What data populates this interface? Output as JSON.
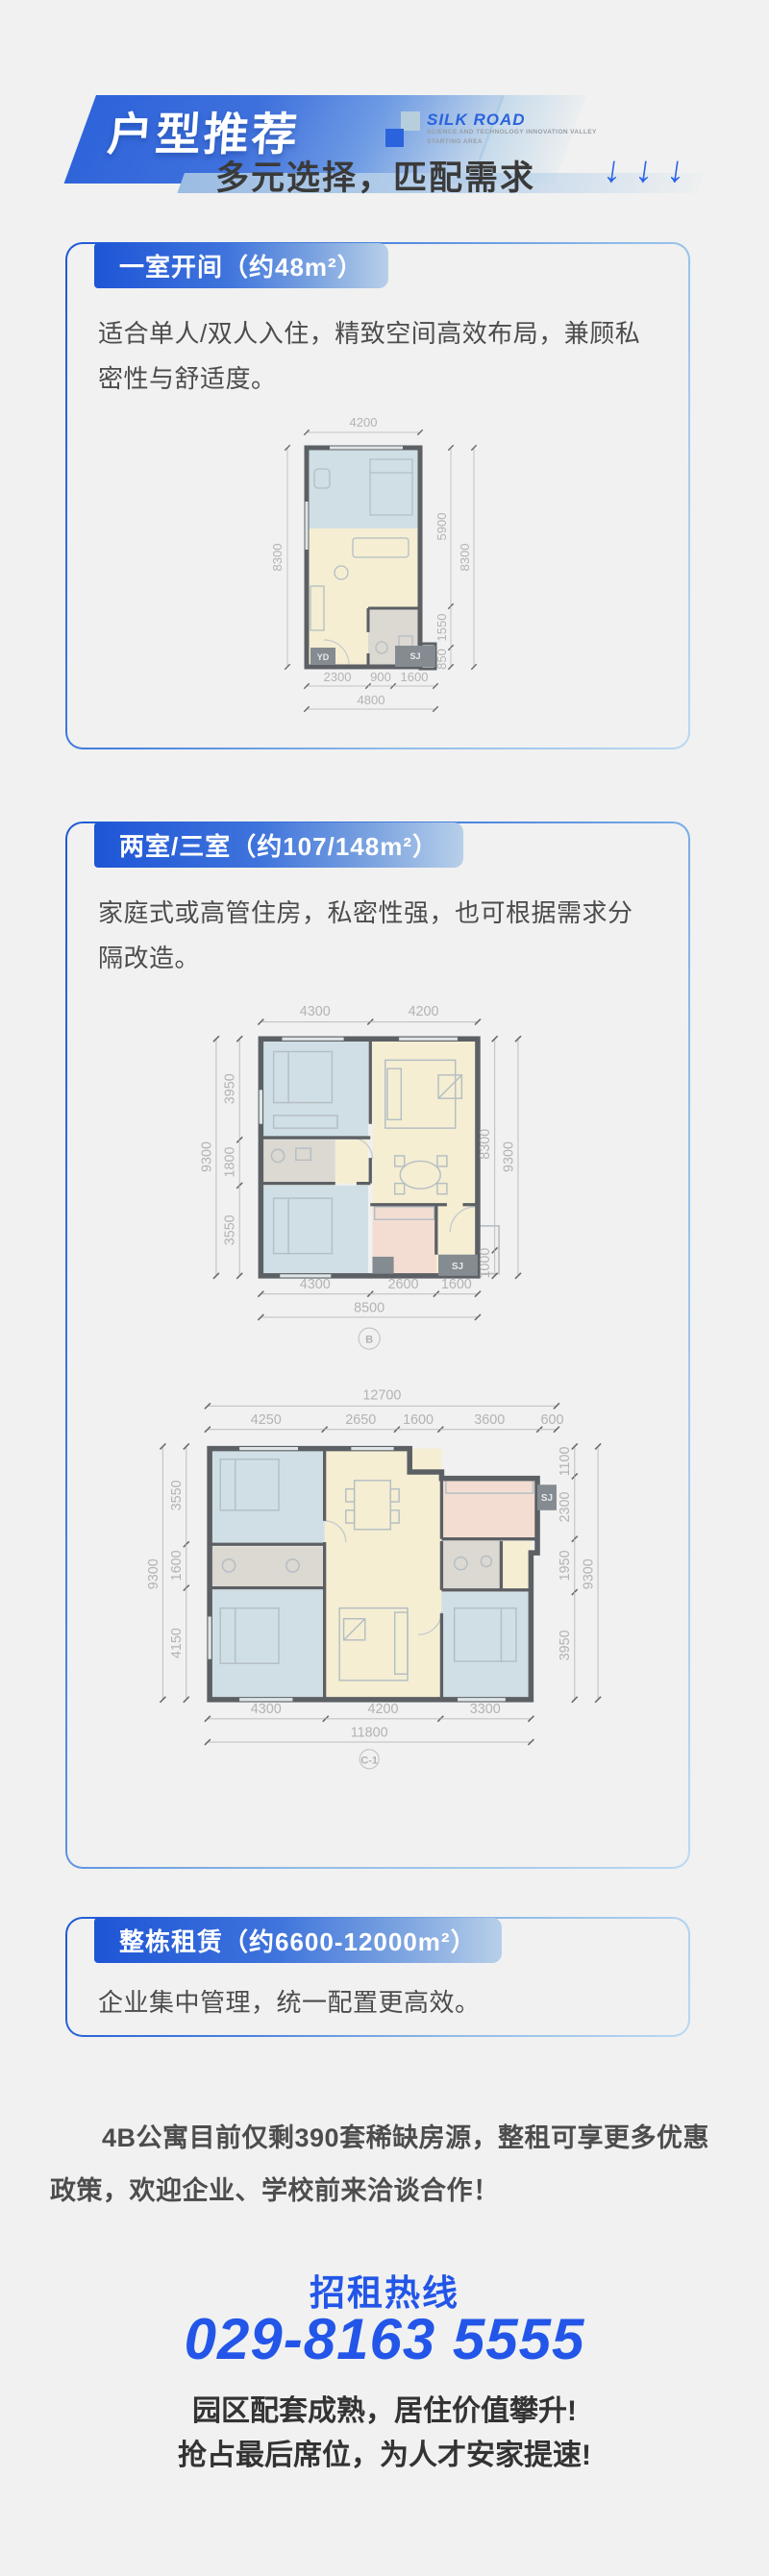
{
  "header": {
    "title": "户型推荐",
    "subtitle": "多元选择，匹配需求",
    "arrow_icon": "↓",
    "accent": "#2b63dc",
    "logo": {
      "name": "SILK ROAD",
      "line1": "SCIENCE AND TECHNOLOGY INNOVATION VALLEY",
      "line2": "STARTING AREA"
    }
  },
  "cards": [
    {
      "badge": "一室开间（约48m²）",
      "description": "适合单人/双人入住，精致空间高效布局，兼顾私密性与舒适度。"
    },
    {
      "badge": "两室/三室（约107/148m²）",
      "description": "家庭式或高管住房，私密性强，也可根据需求分隔改造。"
    },
    {
      "badge": "整栋租赁（约6600-12000m²）",
      "description": "企业集中管理，统一配置更高效。"
    }
  ],
  "floorplans": {
    "p1": {
      "top_total": "4200",
      "left_outer": "8300",
      "right_inner": [
        "5900",
        "1550",
        "850"
      ],
      "right_outer": "8300",
      "bottom": [
        "2300",
        "900",
        "1600"
      ],
      "bottom_total": "4800",
      "tags": [
        "YD",
        "SJ"
      ]
    },
    "p2": {
      "top": [
        "4300",
        "4200"
      ],
      "left_inner": [
        "3950",
        "1800",
        "3550"
      ],
      "left_outer": "9300",
      "right_inner": [
        "8300",
        "1000"
      ],
      "right_outer": "9300",
      "bottom": [
        "4300",
        "2600",
        "1600"
      ],
      "bottom_total": "8500",
      "marker": "B",
      "tags": [
        "SJ"
      ]
    },
    "p3": {
      "top_total": "12700",
      "top": [
        "4250",
        "2650",
        "1600",
        "3600",
        "600"
      ],
      "left_inner": [
        "3550",
        "1600",
        "4150"
      ],
      "left_outer": "9300",
      "right_inner": [
        "1100",
        "2300",
        "1950",
        "3950"
      ],
      "right_outer": "9300",
      "bottom": [
        "4300",
        "4200",
        "3300"
      ],
      "bottom_total": "11800",
      "marker": "C-1",
      "tags": [
        "SJ"
      ]
    }
  },
  "footer": {
    "paragraph": "4B公寓目前仅剩390套稀缺房源，整租可享更多优惠政策，欢迎企业、学校前来洽谈合作！",
    "hotline_label": "招租热线",
    "hotline_number": "029-8163 5555",
    "slogan1": "园区配套成熟，居住价值攀升!",
    "slogan2": "抢占最后席位，为人才安家提速!"
  }
}
